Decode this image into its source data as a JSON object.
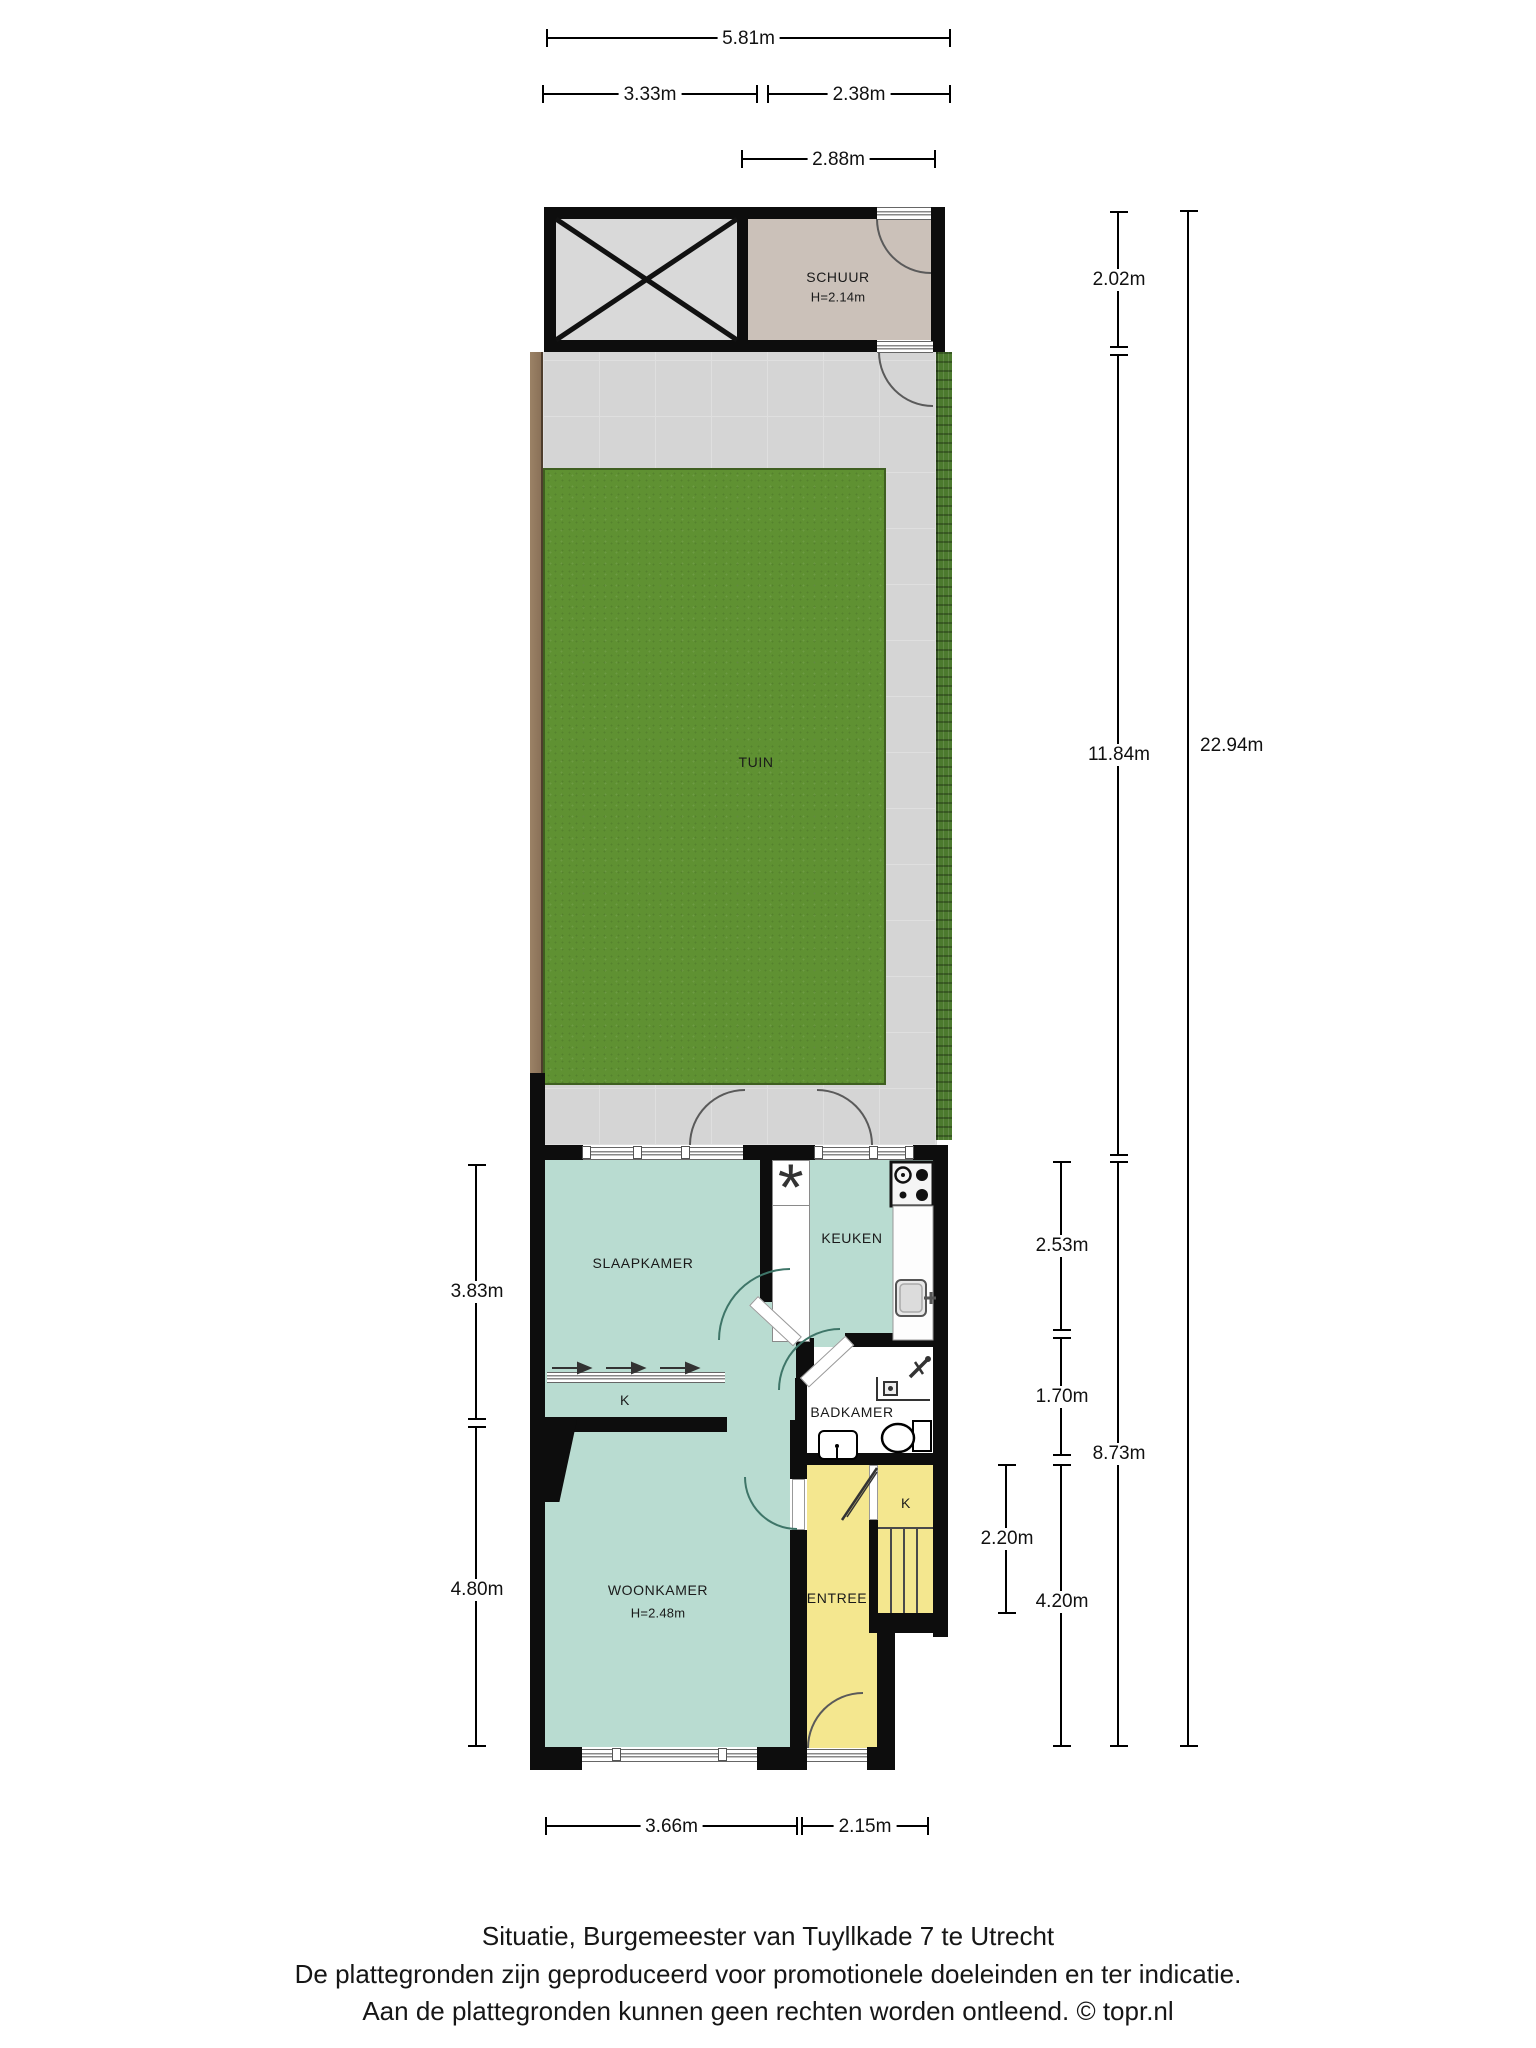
{
  "page": {
    "footer": {
      "line1": "Situatie, Burgemeester van Tuyllkade 7 te Utrecht",
      "line2": "De plattegronden zijn geproduceerd voor promotionele doeleinden en ter indicatie.",
      "line3": "Aan de plattegronden kunnen geen rechten worden ontleend. © topr.nl"
    }
  },
  "rooms": {
    "schuur": {
      "label": "SCHUUR",
      "height": "H=2.14m"
    },
    "tuin": {
      "label": "TUIN"
    },
    "slaapkamer": {
      "label": "SLAAPKAMER"
    },
    "keuken": {
      "label": "KEUKEN"
    },
    "badkamer": {
      "label": "BADKAMER"
    },
    "woonkamer": {
      "label": "WOONKAMER",
      "height": "H=2.48m"
    },
    "entree": {
      "label": "ENTREE"
    },
    "kast_hal": {
      "label": "K"
    },
    "kast_trap": {
      "label": "K"
    }
  },
  "symbols": {
    "flue": "*"
  },
  "dimensions": {
    "top_total": "5.81m",
    "top_left": "3.33m",
    "top_right": "2.38m",
    "schuur_width": "2.88m",
    "right_schuur_depth": "2.02m",
    "right_garden_depth": "11.84m",
    "right_total": "22.94m",
    "keuken_depth": "2.53m",
    "badkamer_depth": "1.70m",
    "house_depth": "8.73m",
    "kast_depth": "2.20m",
    "woonkamer_depth": "4.20m",
    "left_slaapkamer_depth": "3.83m",
    "left_woonkamer_depth": "4.80m",
    "bottom_left": "3.66m",
    "bottom_right": "2.15m"
  },
  "colors": {
    "wall": "#0d0d0d",
    "mint": "#b9dcd1",
    "yellow": "#f4e78f",
    "paving": "#d5d5d5",
    "paving-line": "#dfdfdf",
    "lawn": "#5f9132",
    "lawn-border": "#3f5f21",
    "hedge": "#4c7a2e",
    "fence": "#8a7158",
    "schuur-fill": "#cbc1b9",
    "carport-fill": "#d9d9d9",
    "door-arc": "#3e7568",
    "outdoor-arc": "#5a5a5a",
    "ink": "#1a1a1a"
  }
}
